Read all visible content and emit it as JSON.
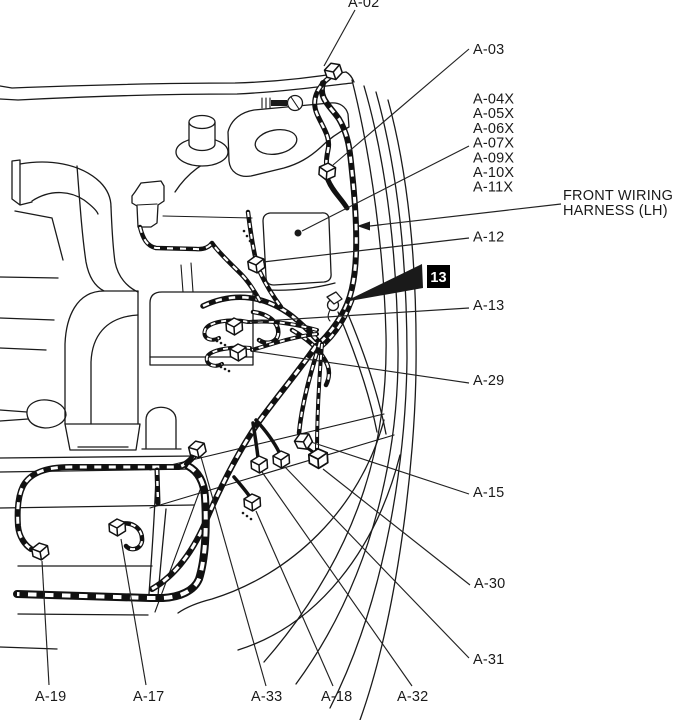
{
  "diagram": {
    "description": "Front wiring harness (LH) connector location diagram - engine compartment left side",
    "colors": {
      "ink": "#1a1a1a",
      "background": "#ffffff",
      "badge_bg": "#000000",
      "badge_text": "#ffffff"
    },
    "labels": {
      "a02": "A-02",
      "a03": "A-03",
      "relay_group": [
        "A-04X",
        "A-05X",
        "A-06X",
        "A-07X",
        "A-09X",
        "A-10X",
        "A-11X"
      ],
      "front_harness_line1": "FRONT WIRING",
      "front_harness_line2": "HARNESS (LH)",
      "a12": "A-12",
      "clip_badge": "13",
      "a13": "A-13",
      "a29": "A-29",
      "a15": "A-15",
      "a30": "A-30",
      "a31": "A-31",
      "a19": "A-19",
      "a17": "A-17",
      "a33": "A-33",
      "a18": "A-18",
      "a32": "A-32"
    }
  }
}
